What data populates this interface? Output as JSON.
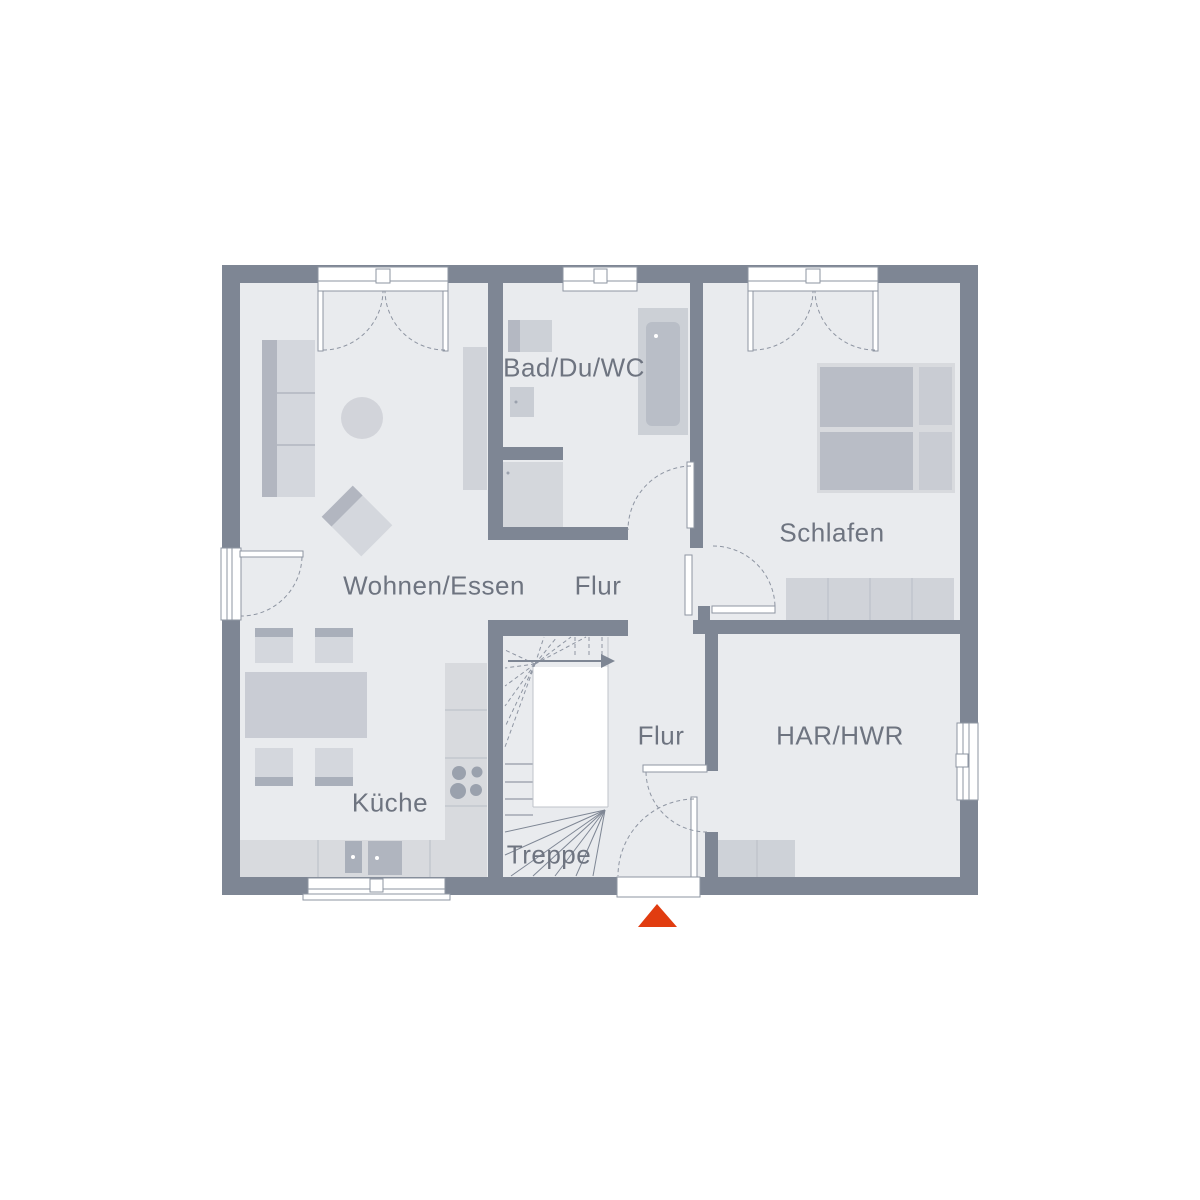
{
  "page": {
    "background": "#ffffff"
  },
  "floorplan": {
    "type": "floor-plan",
    "rooms": [
      {
        "label": "Bad/Du/WC"
      },
      {
        "label": "Schlafen"
      },
      {
        "label": "Wohnen/Essen"
      },
      {
        "label": "Flur"
      },
      {
        "label": "Flur"
      },
      {
        "label": "HAR/HWR"
      },
      {
        "label": "Küche"
      },
      {
        "label": "Treppe"
      }
    ],
    "entrance_marker": {
      "shape": "triangle-up",
      "color": "#e13c10"
    },
    "colors": {
      "walls": "#7e8694",
      "floor": "#e9ebee",
      "furniture_light": "#d4d7dd",
      "furniture_mid": "#c9ccd4",
      "furniture_dark": "#aab0ba",
      "outline": "#8e95a2",
      "label_text": "#6e7480"
    }
  }
}
